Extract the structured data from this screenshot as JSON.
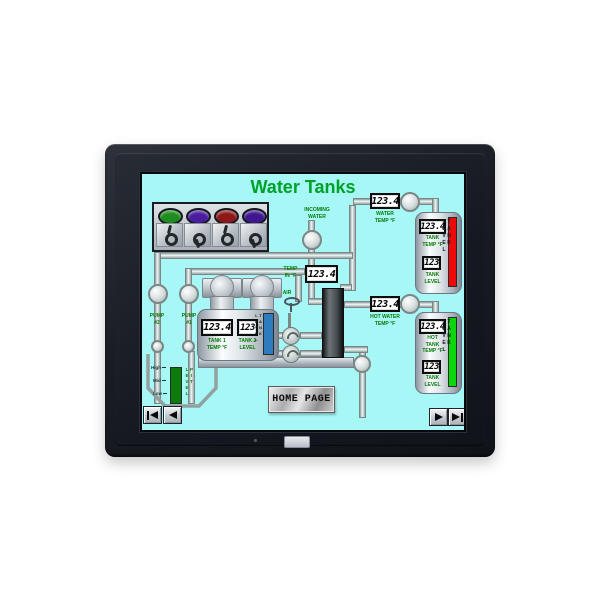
{
  "hmi": {
    "title": "Water Tanks",
    "colors": {
      "screen_bg": "#a7f7f7",
      "title_green": "#00a128",
      "label_green": "#067a06",
      "bar_red": "#ee0a0a",
      "bar_green": "#0ad80a",
      "bar_blue": "#2d7cc0",
      "bar_pit_green": "#0b7c0b"
    },
    "lights": [
      {
        "id": "indicator-green",
        "color": "#1f8c1f"
      },
      {
        "id": "indicator-violet",
        "color": "#4a1d9e"
      },
      {
        "id": "indicator-red",
        "color": "#8e1818"
      },
      {
        "id": "indicator-purple",
        "color": "#3f1690"
      }
    ],
    "switches": [
      "up",
      "down",
      "up",
      "down"
    ],
    "incoming_water_label": "INCOMING\nWATER",
    "air_label": "AIR",
    "temp_in": {
      "value": "123.4",
      "label": "TEMP\nIN °F"
    },
    "water_temp": {
      "value": "123.4",
      "label": "WATER\nTEMP °F"
    },
    "hot_water_temp": {
      "value": "123.4",
      "label": "HOT WATER\nTEMP °F"
    },
    "pump2_label": "PUMP\n#2",
    "pump1_label": "PUMP\n#1",
    "left_tank": {
      "temp_value": "123.4",
      "temp_label": "TANK 1\nTEMP °F",
      "level_value": "123",
      "level_label": "TANK 2\nLEVEL",
      "side_label": "TANK LEVEL"
    },
    "cold_tank": {
      "temp_value": "123.4",
      "temp_label": "TANK\nTEMP °F",
      "level_value": "123",
      "level_label": "TANK\nLEVEL",
      "side_label": "TANK LEVEL"
    },
    "hot_tank": {
      "temp_value": "123.4",
      "temp_label": "HOT\nTANK\nTEMP °F",
      "level_value": "123",
      "level_label": "TANK\nLEVEL",
      "side_label": "TANK LEVEL"
    },
    "pit": {
      "scale": [
        "High",
        "Mid",
        "Low"
      ],
      "side_label": "PIT LEVEL"
    },
    "home_button": "HOME PAGE",
    "nav": {
      "first_icon": "skip-to-first",
      "prev_icon": "previous",
      "next_icon": "next",
      "last_icon": "skip-to-last"
    }
  }
}
